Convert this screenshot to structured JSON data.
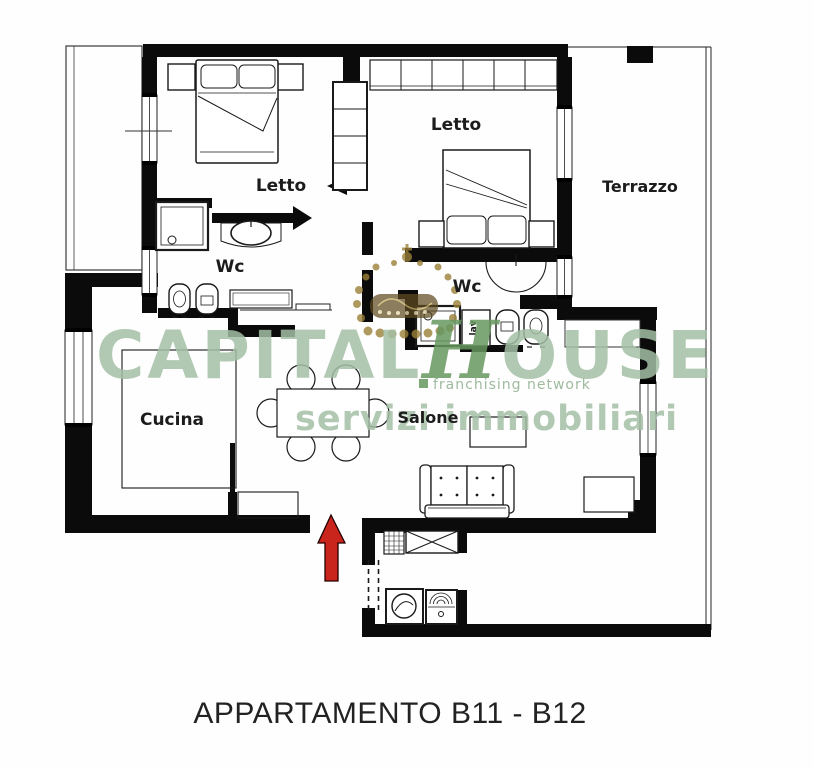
{
  "plan": {
    "caption": "APPARTAMENTO B11 - B12",
    "rooms": {
      "letto1": "Letto",
      "letto2": "Letto",
      "terrazzo": "Terrazzo",
      "wc1": "Wc",
      "wc2": "Wc",
      "cucina": "Cucina",
      "salone": "Salone"
    },
    "fixtures": {
      "washing_machine_label": "lav"
    },
    "entrance_arrow_color": "#c9251d",
    "wall_color": "#0b0b0b"
  },
  "watermark": {
    "brand_part1": "CAPITAL",
    "brand_part2_initial": "H",
    "brand_part2_rest": "OUSE",
    "tagline": "franchising network",
    "subtitle": "servizi immobiliari",
    "brand_color": "#a3bfa6",
    "accent_color": "#67985f",
    "crown_color": "#9a8038"
  }
}
